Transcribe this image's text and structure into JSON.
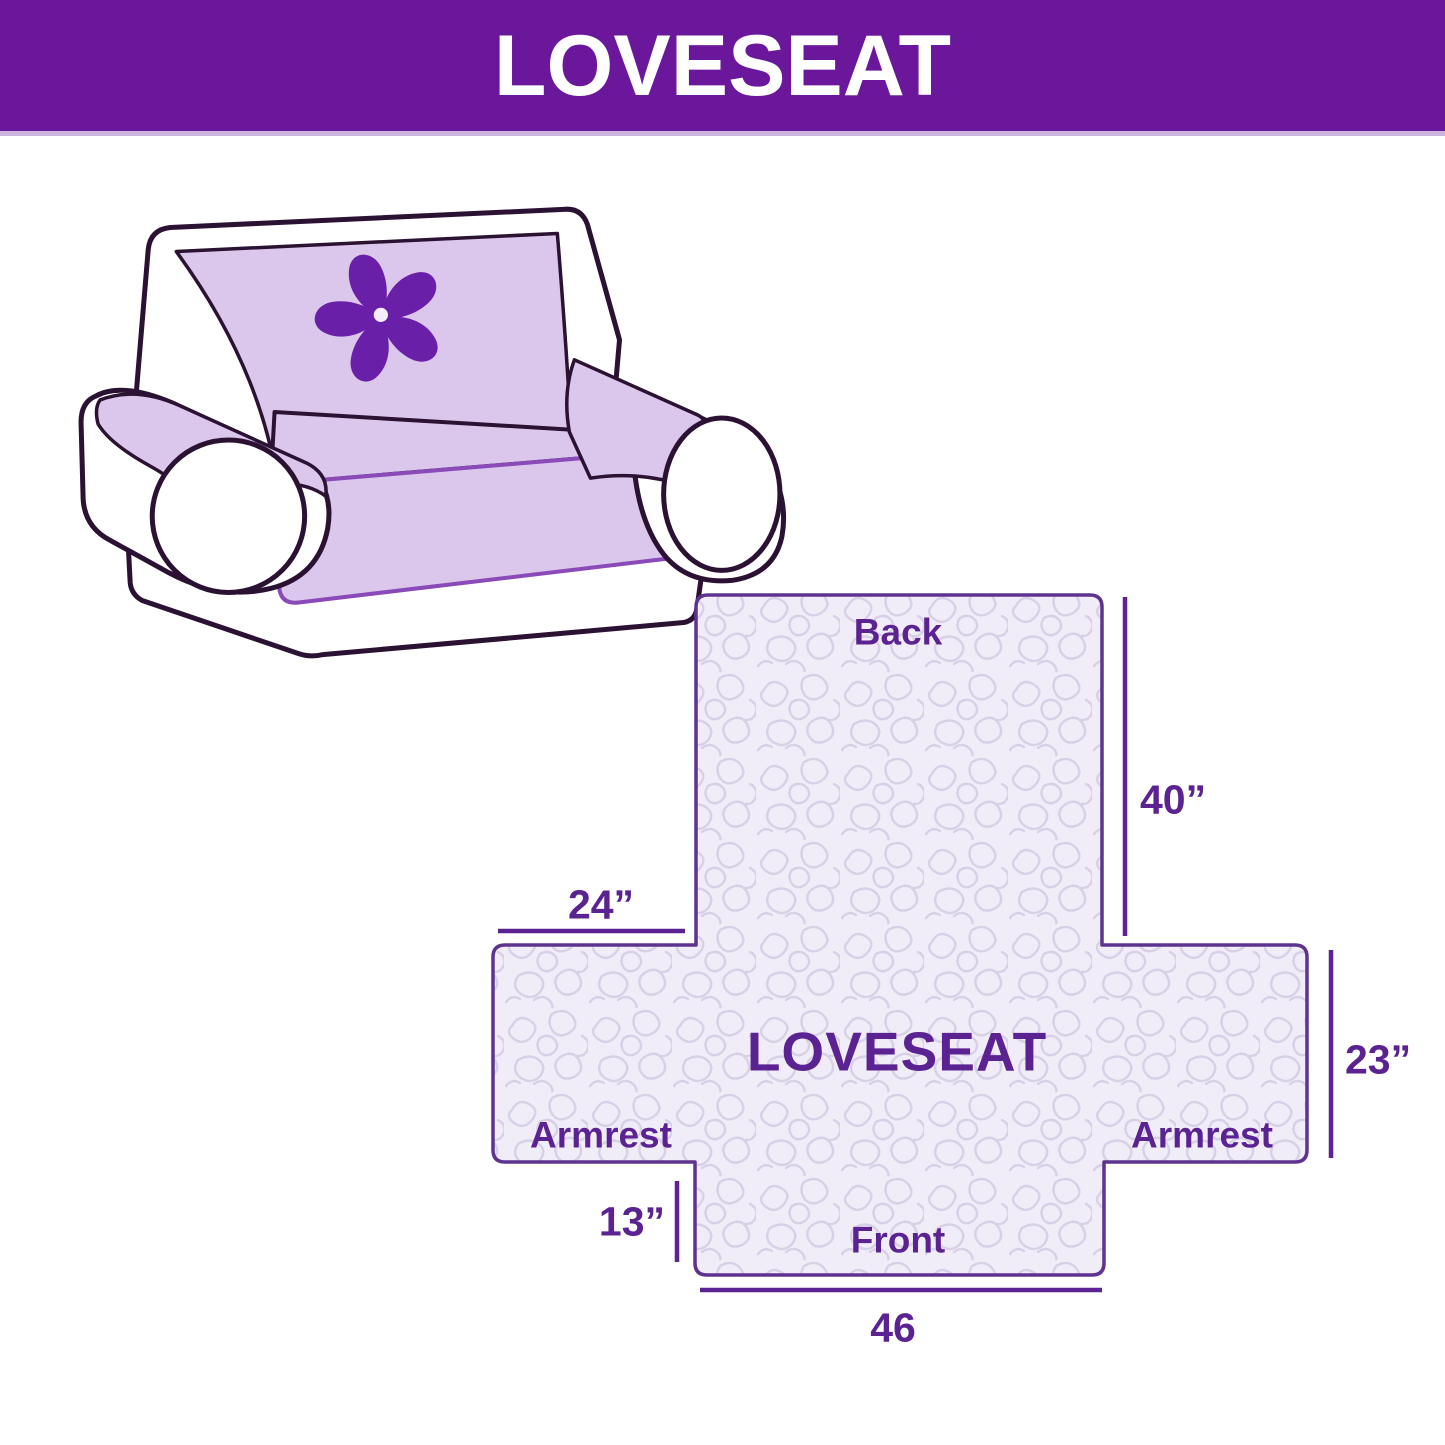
{
  "banner": {
    "title": "LOVESEAT",
    "background_color": "#6A179B",
    "text_color": "#FFFFFF"
  },
  "sofa": {
    "logo_icon": "pinwheel-flower-icon",
    "body_color": "#FFFFFF",
    "cover_color": "#DCC7EC",
    "outline_color": "#2B1233",
    "logo_color": "#6A1FA8"
  },
  "diagram": {
    "labels": {
      "back": "Back",
      "center": "LOVESEAT",
      "armrest_left": "Armrest",
      "armrest_right": "Armrest",
      "front": "Front"
    },
    "dimensions": {
      "back_height": "40”",
      "back_top_width": "24”",
      "armrest_height": "23”",
      "front_drop": "13”",
      "front_width": "46"
    },
    "dimension_values_inches": {
      "back_height": 40,
      "back_top_width": 24,
      "armrest_height": 23,
      "front_drop": 13,
      "front_width": 46
    },
    "colors": {
      "outline": "#5E3390",
      "fill": "#F1EDF8",
      "squiggle": "#D8D0E6",
      "label": "#5B2391"
    }
  }
}
